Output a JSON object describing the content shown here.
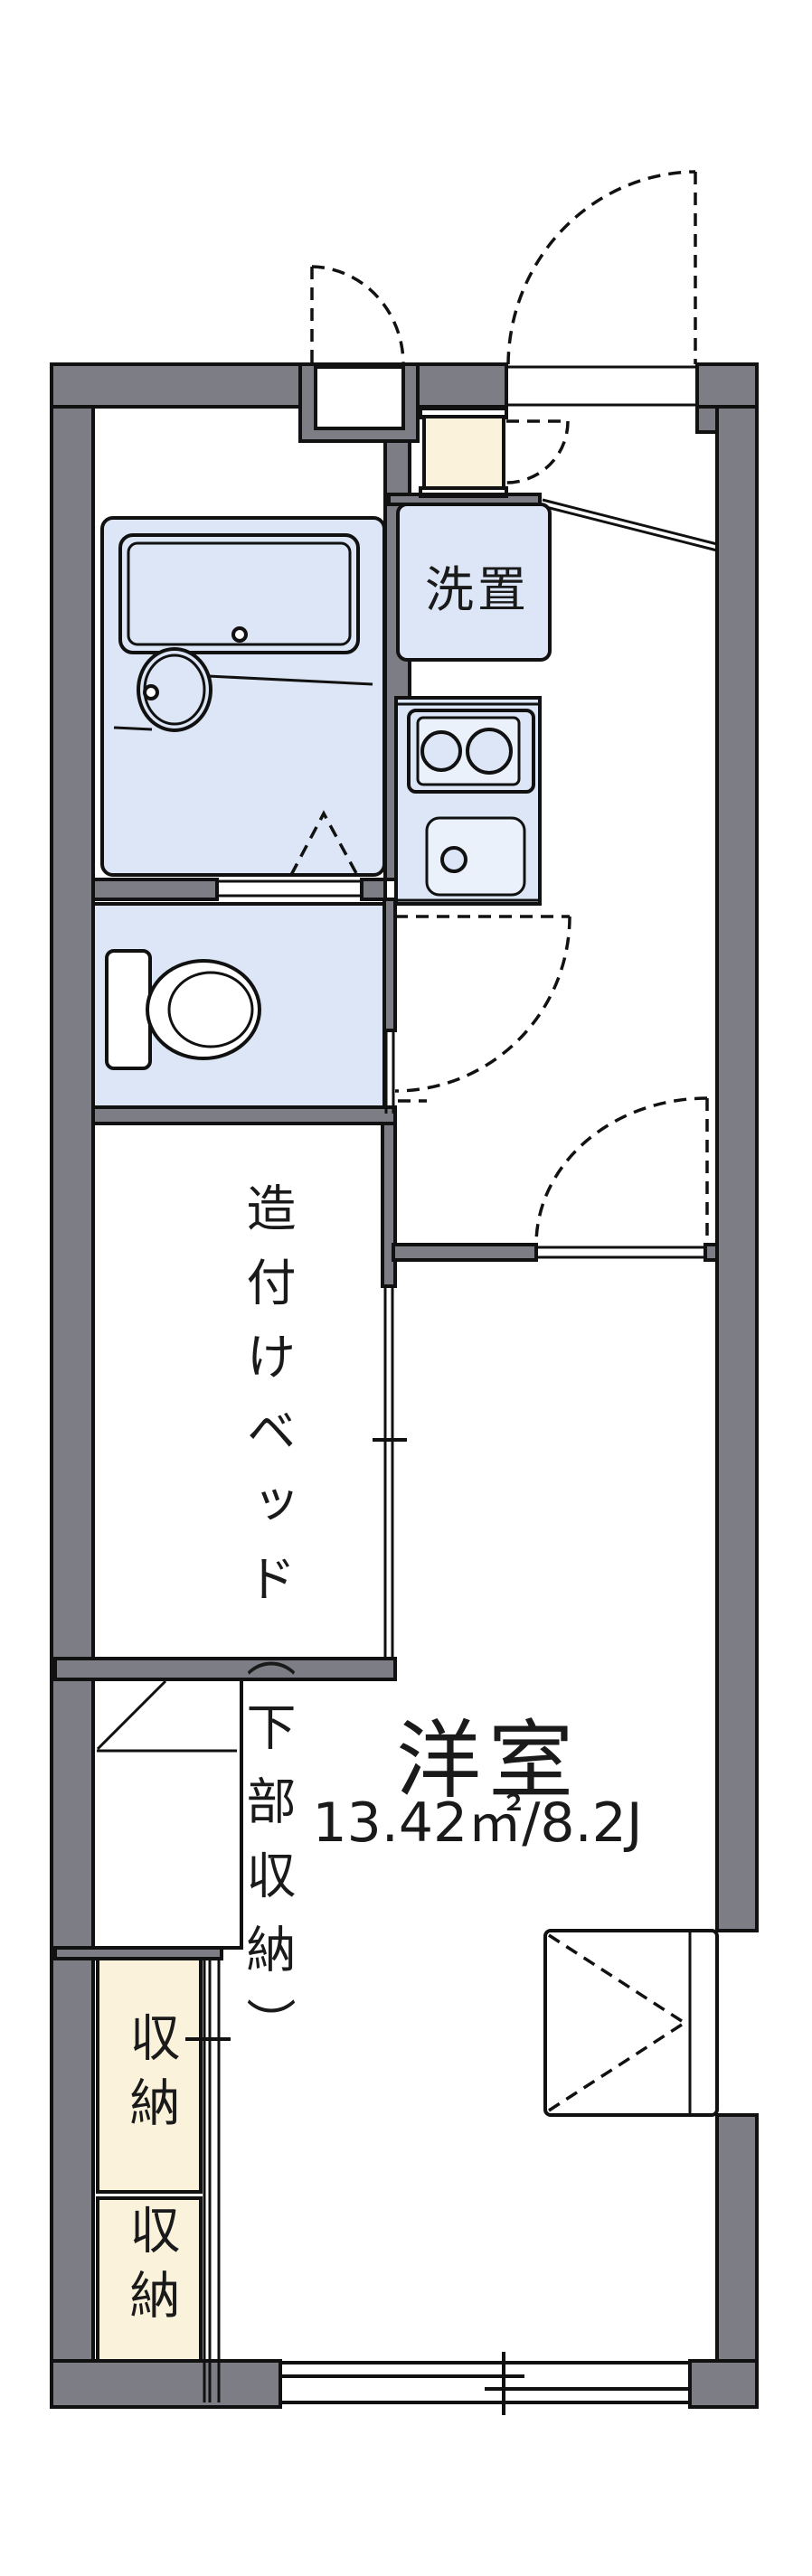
{
  "floorplan": {
    "labels": {
      "laundry": "洗置",
      "bed": "造付けベッド（下部収納）",
      "storage_top": "収納",
      "storage_bottom": "収納",
      "room_name": "洋室",
      "room_size": "13.42㎡/8.2J"
    },
    "colors": {
      "wall": "#7d7d85",
      "room": "#dce6f6",
      "room_light": "#ebf1fa",
      "storage": "#fbf2dc",
      "line": "#111111",
      "bg": "#ffffff"
    }
  }
}
